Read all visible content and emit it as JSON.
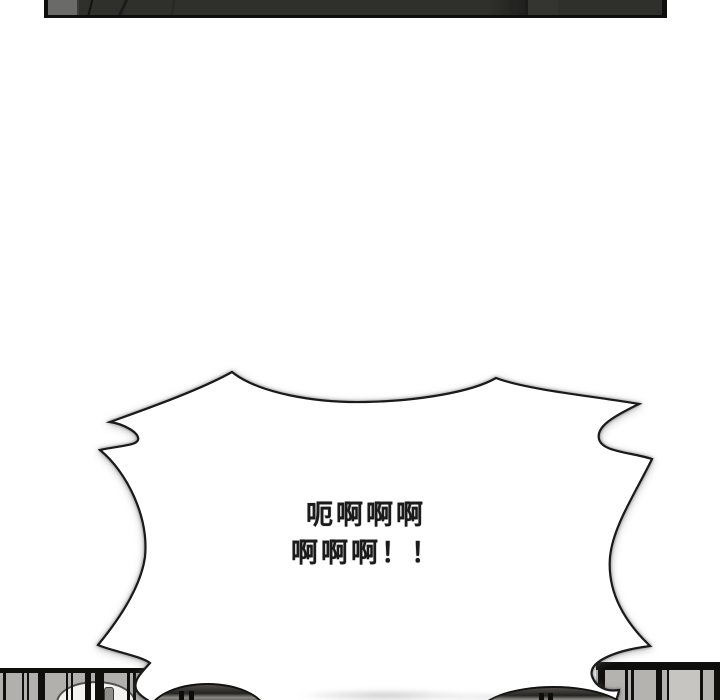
{
  "comic": {
    "speech_bubble": {
      "lines": [
        "呃啊啊啊",
        "啊啊啊！！"
      ],
      "fill": "#ffffff",
      "outline_color": "#1a1a1a"
    },
    "panels": {
      "top_panel_fill": "#2f2f2b",
      "panel_border_color": "#0e0e0c",
      "grille_fill": "#b2b0ad",
      "grille_bar_color": "#0f0f0d",
      "dome_fill": "#23231f",
      "page_background": "#ffffff"
    }
  }
}
